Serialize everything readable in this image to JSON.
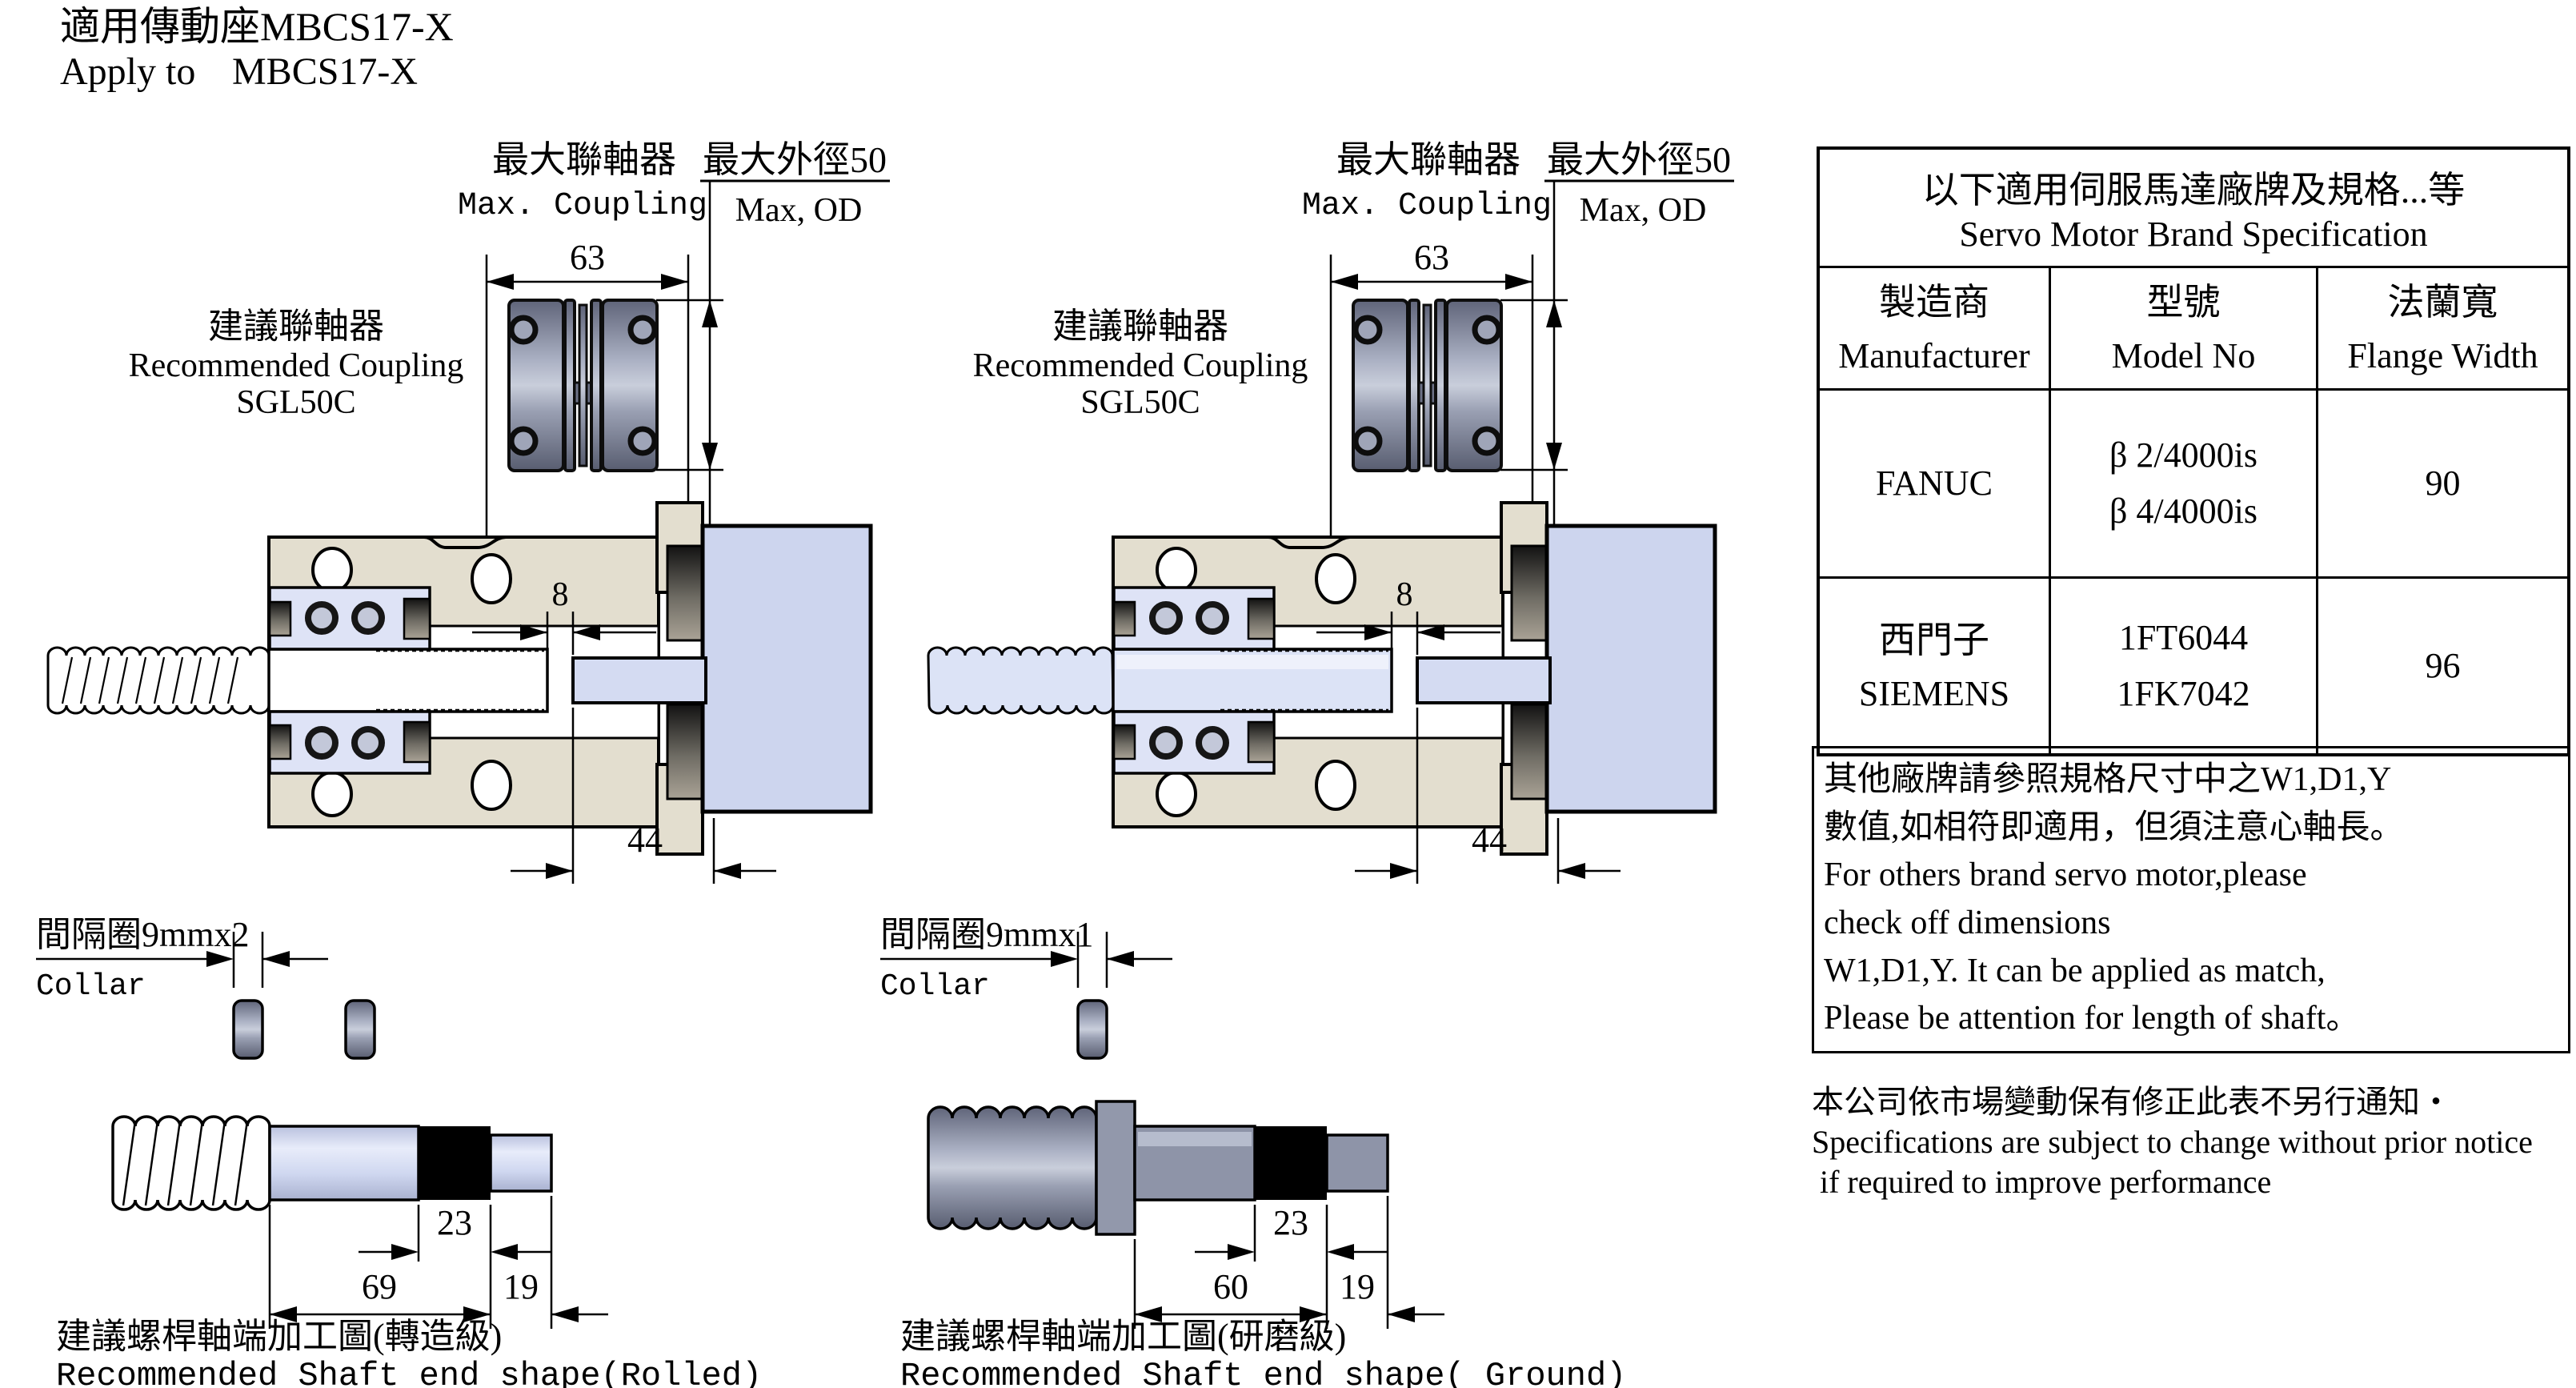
{
  "page": {
    "title_zh": "適用傳動座MBCS17-X",
    "title_en_1": "Apply to",
    "title_en_2": "MBCS17-X"
  },
  "assemblies": [
    {
      "max_coupling_zh": "最大聯軸器",
      "max_coupling_en": "Max. Coupling",
      "max_od_zh": "最大外徑50",
      "max_od_en": "Max, OD",
      "dim_width": "63",
      "dim_gap": "8",
      "dim_depth": "44",
      "rec_zh": "建議聯軸器",
      "rec_en": "Recommended Coupling",
      "rec_model": "SGL50C",
      "collar_zh": "間隔圈9mmx2",
      "collar_en": "Collar",
      "dim_band": "23",
      "dim_len": "69",
      "dim_end": "19",
      "shaft_zh": "建議螺桿軸端加工圖(轉造級)",
      "shaft_en": "Recommended Shaft end shape(Rolled)"
    },
    {
      "max_coupling_zh": "最大聯軸器",
      "max_coupling_en": "Max. Coupling",
      "max_od_zh": "最大外徑50",
      "max_od_en": "Max, OD",
      "dim_width": "63",
      "dim_gap": "8",
      "dim_depth": "44",
      "rec_zh": "建議聯軸器",
      "rec_en": "Recommended Coupling",
      "rec_model": "SGL50C",
      "collar_zh": "間隔圈9mmx1",
      "collar_en": "Collar",
      "dim_band": "23",
      "dim_len": "60",
      "dim_end": "19",
      "shaft_zh": "建議螺桿軸端加工圖(研磨級)",
      "shaft_en": "Recommended Shaft end shape( Ground)"
    }
  ],
  "table": {
    "title_zh": "以下適用伺服馬達廠牌及規格...等",
    "title_en": "Servo Motor Brand Specification",
    "headers": [
      {
        "zh": "製造商",
        "en": "Manufacturer"
      },
      {
        "zh": "型號",
        "en": "Model No"
      },
      {
        "zh": "法蘭寬",
        "en": "Flange Width"
      }
    ],
    "rows": [
      {
        "maker_zh": "",
        "maker_en": "FANUC",
        "model_1": "β 2/4000is",
        "model_2": "β 4/4000is",
        "flange": "90"
      },
      {
        "maker_zh": "西門子",
        "maker_en": "SIEMENS",
        "model_1": "1FT6044",
        "model_2": "1FK7042",
        "flange": "96"
      }
    ]
  },
  "note": {
    "l1": "其他廠牌請參照規格尺寸中之W1,D1,Y",
    "l2": "數值,如相符即適用，但須注意心軸長。",
    "l3": "For others brand servo motor,please",
    "l4": "check off dimensions",
    "l5": "W1,D1,Y. It can be applied as match,",
    "l6": "Please be attention for length of shaft。"
  },
  "footer": {
    "l1": "本公司依市場變動保有修正此表不另行通知・",
    "l2": "Specifications are subject to change without prior notice",
    "l3": "if required to improve performance"
  }
}
